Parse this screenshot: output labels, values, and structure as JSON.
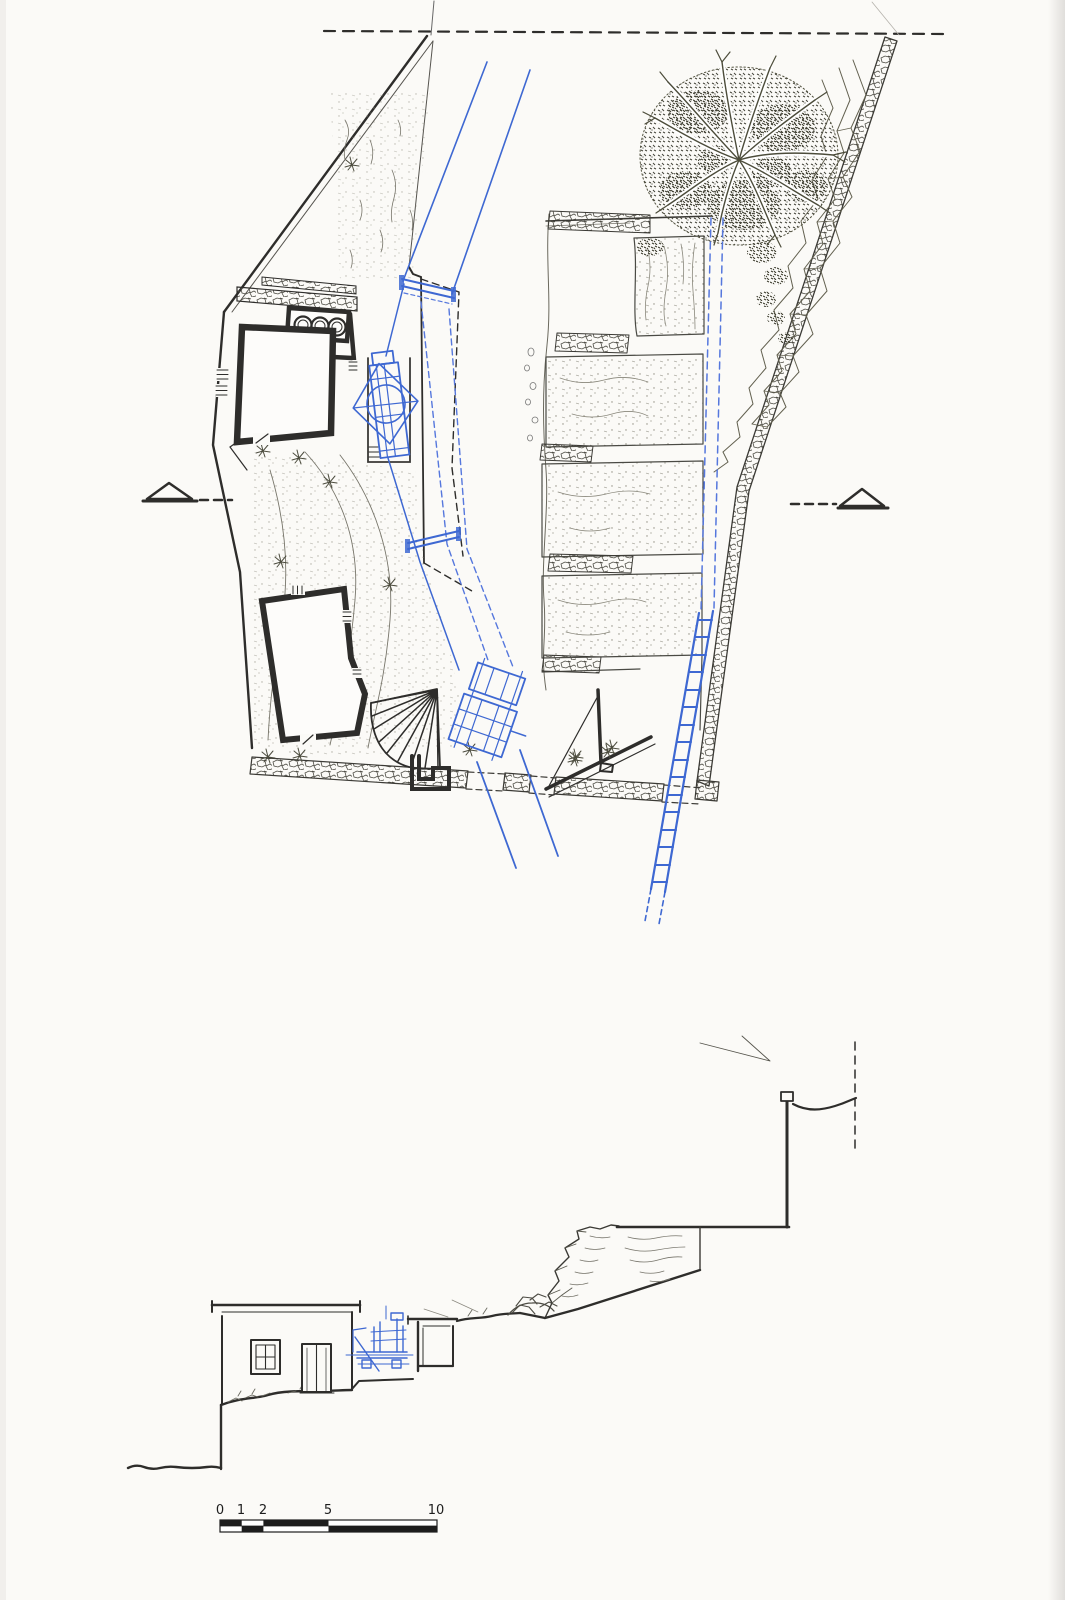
{
  "scale_bar": {
    "labels": [
      "0",
      "1",
      "2",
      "5",
      "10"
    ]
  },
  "colors": {
    "paper": "#fbfaf7",
    "ink": "#2e2d2b",
    "ink_light": "#8a887f",
    "blue": "#3e68d2",
    "blue_dash": "#5577dd",
    "foliage": "#45453a"
  },
  "icons": {
    "left_marker": "section-cut-triangle",
    "right_marker": "section-cut-triangle",
    "tree": "tree-plan-symbol",
    "ladder": "ladder-symbol"
  }
}
